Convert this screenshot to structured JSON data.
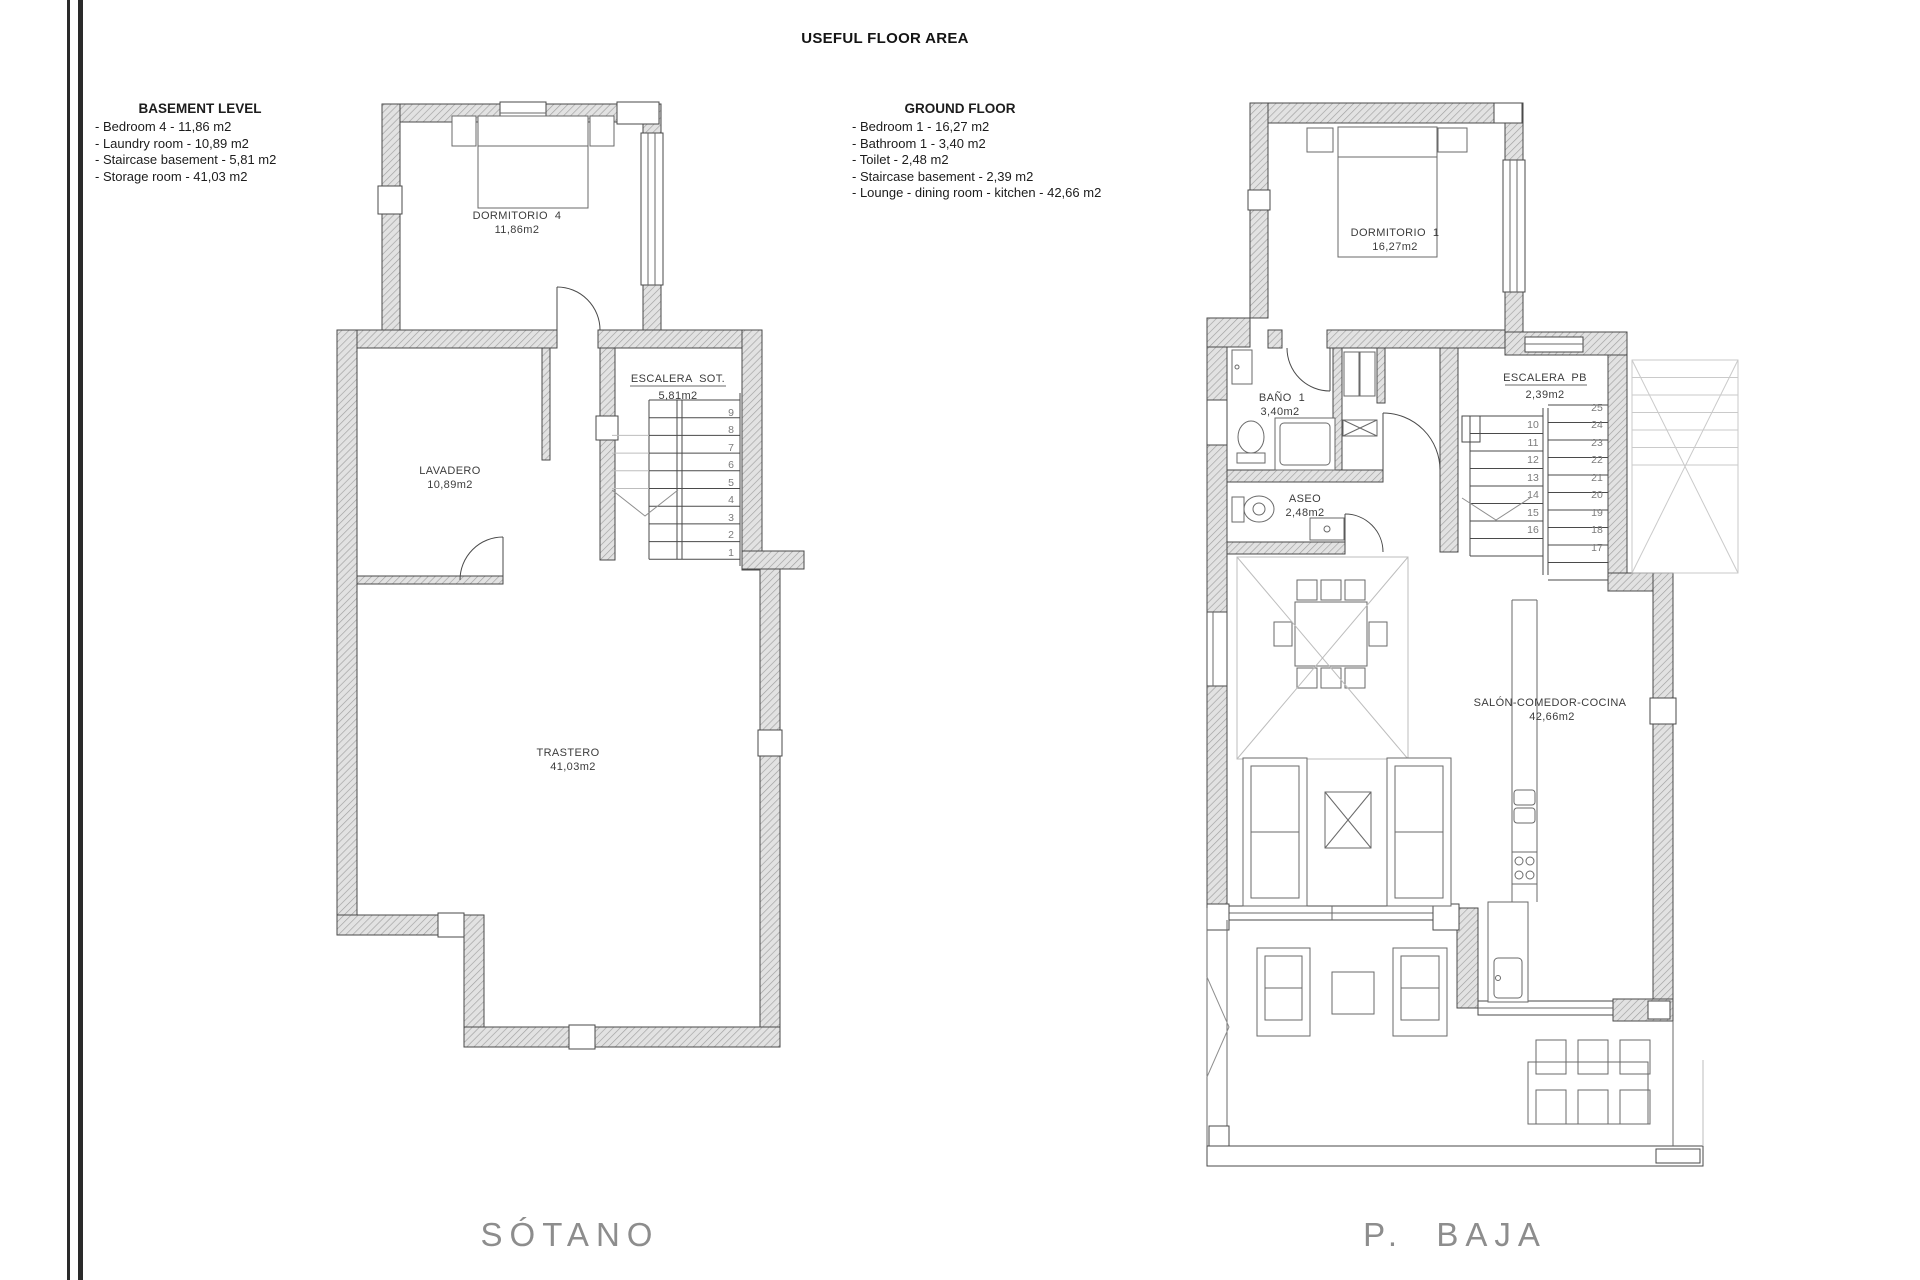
{
  "title": "USEFUL FLOOR AREA",
  "legend_left": {
    "heading": "BASEMENT LEVEL",
    "items": [
      "- Bedroom 4 - 11,86 m2",
      "- Laundry room - 10,89 m2",
      "- Staircase basement - 5,81 m2",
      "- Storage room - 41,03 m2"
    ]
  },
  "legend_right": {
    "heading": "GROUND FLOOR",
    "items": [
      "- Bedroom 1 - 16,27 m2",
      "- Bathroom 1 - 3,40 m2",
      "- Toilet - 2,48 m2",
      "- Staircase basement - 2,39 m2",
      "- Lounge - dining room - kitchen - 42,66 m2"
    ]
  },
  "plans": {
    "basement": {
      "name": "SÓTANO",
      "rooms": {
        "bedroom": {
          "label": "DORMITORIO  4",
          "area": "11,86m2"
        },
        "laundry": {
          "label": "LAVADERO",
          "area": "10,89m2"
        },
        "stairs": {
          "label": "ESCALERA  SOT.",
          "area": "5,81m2"
        },
        "storage": {
          "label": "TRASTERO",
          "area": "41,03m2"
        }
      },
      "stair_numbers": [
        "9",
        "8",
        "7",
        "6",
        "5",
        "4",
        "3",
        "2",
        "1"
      ]
    },
    "ground": {
      "name": "P.  BAJA",
      "rooms": {
        "bedroom": {
          "label": "DORMITORIO  1",
          "area": "16,27m2"
        },
        "bathroom": {
          "label": "BAÑO  1",
          "area": "3,40m2"
        },
        "toilet": {
          "label": "ASEO",
          "area": "2,48m2"
        },
        "stairs": {
          "label": "ESCALERA  PB",
          "area": "2,39m2"
        },
        "lounge": {
          "label": "SALÓN-COMEDOR-COCINA",
          "area": "42,66m2"
        }
      },
      "stair_lower": [
        "10",
        "11",
        "12",
        "13",
        "14",
        "15",
        "16"
      ],
      "stair_upper": [
        "25",
        "24",
        "23",
        "22",
        "21",
        "20",
        "19",
        "18",
        "17"
      ]
    }
  },
  "colors": {
    "wall_fill": "#e2e2e2",
    "wall_hatch": "#a0a0a0",
    "line": "#4a4a4a",
    "label_text": "#3c3c3c",
    "ghost": "#bdbdbd",
    "plan_name_text": "#8d8d8d"
  }
}
